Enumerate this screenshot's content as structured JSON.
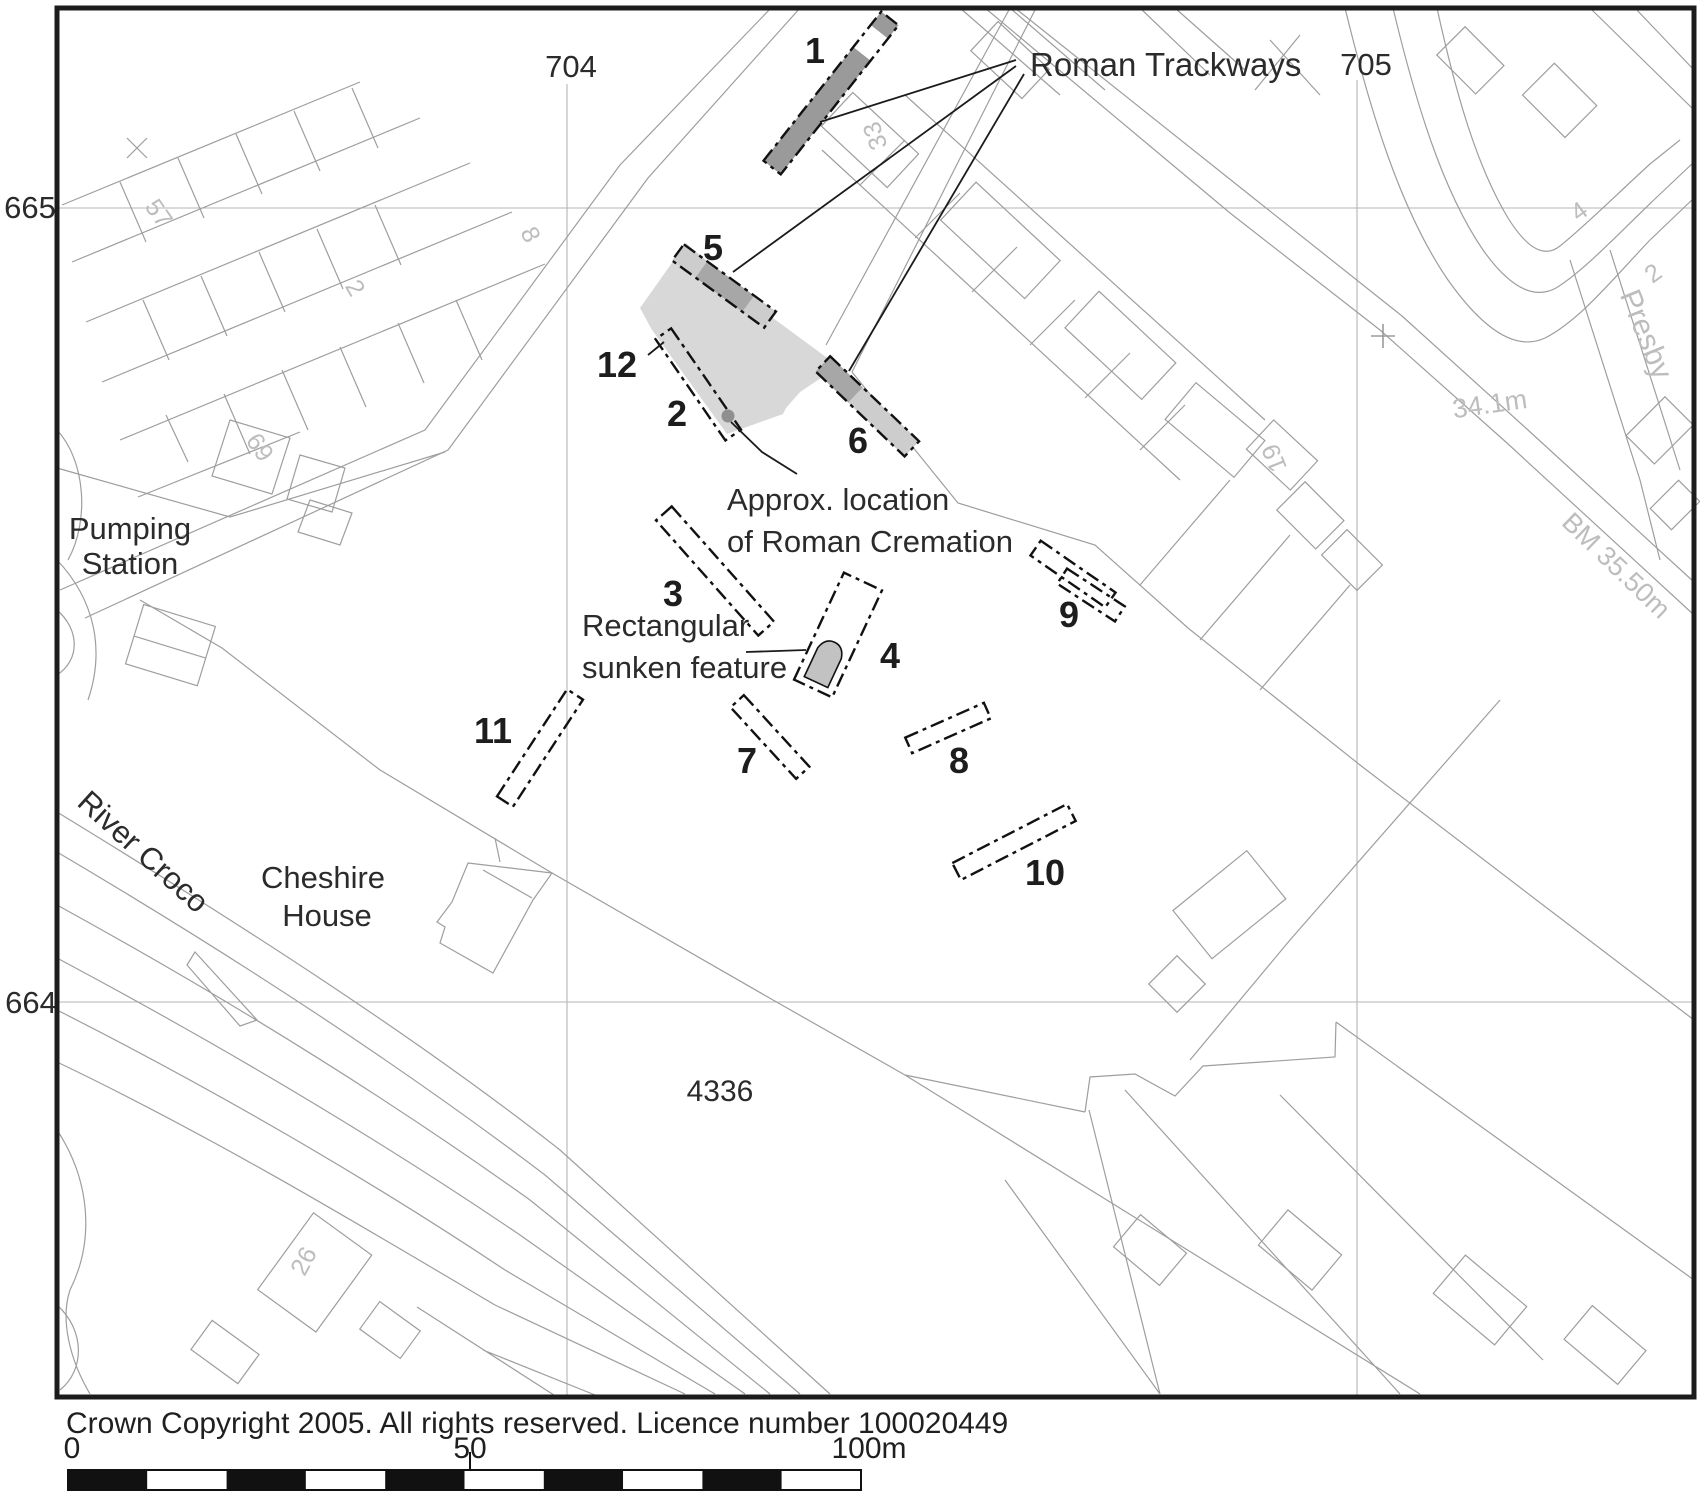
{
  "map": {
    "grid": {
      "easting_left": "704",
      "easting_right": "705",
      "northing_top": "665",
      "northing_bottom": "664"
    },
    "annotations": {
      "roman_trackways": "Roman Trackways",
      "cremation_line1": "Approx. location",
      "cremation_line2": "of Roman Cremation",
      "sunken_line1": "Rectangular",
      "sunken_line2": "sunken feature",
      "pumping_line1": "Pumping",
      "pumping_line2": "Station",
      "river": "River Croco",
      "cheshire_line1": "Cheshire",
      "cheshire_line2": "House",
      "parcel_number": "4336"
    },
    "trenches": [
      {
        "label": "1"
      },
      {
        "label": "2"
      },
      {
        "label": "3"
      },
      {
        "label": "4"
      },
      {
        "label": "5"
      },
      {
        "label": "6"
      },
      {
        "label": "7"
      },
      {
        "label": "8"
      },
      {
        "label": "9"
      },
      {
        "label": "10"
      },
      {
        "label": "11"
      },
      {
        "label": "12"
      }
    ],
    "street_labels": {
      "presby": "Presby",
      "spot_height": "34.1m",
      "benchmark": "BM 35.50m",
      "h57": "57",
      "h69": "69",
      "h33": "33",
      "h19": "19",
      "h26": "26",
      "h2_terrace": "2",
      "h8": "8",
      "h4": "4",
      "h2_presby": "2"
    },
    "colors": {
      "trackway_fill": "#9a9a9a",
      "excavation_area_fill": "#d8d8d8",
      "linework": "#9e9e9e"
    }
  },
  "footer": {
    "copyright": "Crown Copyright 2005. All rights reserved. Licence number 100020449",
    "scale": {
      "start": "0",
      "mid": "50",
      "end": "100m"
    }
  }
}
